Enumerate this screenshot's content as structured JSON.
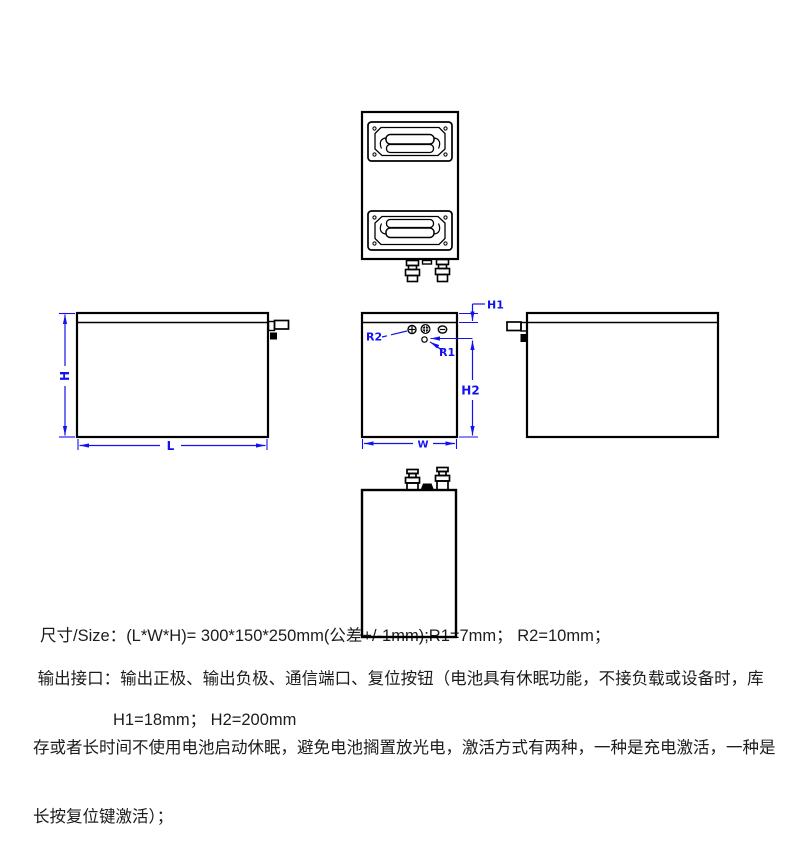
{
  "page": {
    "background": "#ffffff",
    "drawing_line_color": "#000000",
    "dimension_color": "#1212ee",
    "text_color": "#1c1c1c"
  },
  "icons": {
    "positive_terminal": "plus-in-circle",
    "communication_port": "clover-in-circle",
    "negative_terminal": "minus-in-circle",
    "reset_button": "small-circle",
    "handle": "recessed-pull-handle"
  },
  "dimensions": {
    "h": "H",
    "l": "L",
    "w": "W",
    "h1": "H1",
    "h2": "H2",
    "r1": "R1",
    "r2": "R2"
  },
  "specs": {
    "size_label": "尺寸/Size：",
    "size_value": "(L*W*H)= 300*150*250mm(公差+/-1mm);R1=7mm； R2=10mm；",
    "size_line2": "H1=18mm； H2=200mm",
    "interface_line1": " 输出接口：输出正极、输出负极、通信端口、复位按钮（电池具有休眠功能，不接负载或设备时，库",
    "interface_line2": "存或者长时间不使用电池启动休眠，避免电池搁置放光电，激活方式有两种，一种是充电激活，一种是",
    "interface_line3": "长按复位键激活）；"
  }
}
